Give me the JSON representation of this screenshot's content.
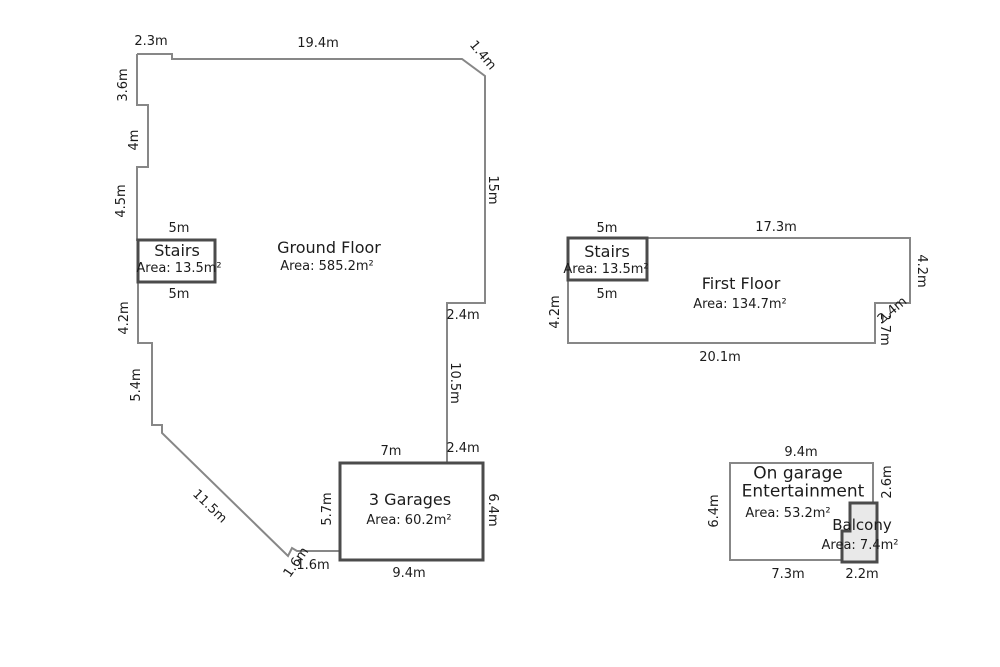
{
  "ground_floor": {
    "title": "Ground Floor",
    "area": "Area: 585.2m²",
    "stairs": {
      "title": "Stairs",
      "area": "Area: 13.5m²",
      "dim_top": "5m",
      "dim_bottom": "5m"
    },
    "dims": {
      "top_left": "2.3m",
      "top": "19.4m",
      "top_right_diag": "1.4m",
      "left_1": "3.6m",
      "left_2": "4m",
      "left_3": "4.5m",
      "left_4": "4.2m",
      "left_5": "5.4m",
      "diagonal": "11.5m",
      "notch": "1.6m",
      "right_1": "15m",
      "right_step": "2.4m",
      "right_2": "10.5m",
      "right_bottom_step": "2.4m"
    }
  },
  "garage": {
    "title": "3 Garages",
    "area": "Area: 60.2m²",
    "dims": {
      "top": "7m",
      "left": "5.7m",
      "right": "6.4m",
      "bottom": "9.4m"
    }
  },
  "first_floor": {
    "title": "First Floor",
    "area": "Area: 134.7m²",
    "stairs": {
      "title": "Stairs",
      "area": "Area: 13.5m²",
      "dim_top": "5m",
      "dim_bottom": "5m"
    },
    "dims": {
      "top": "17.3m",
      "left": "4.2m",
      "right": "4.2m",
      "notch_h": "2.4m",
      "notch_v": "2.7m",
      "bottom": "20.1m"
    }
  },
  "entertainment": {
    "title_line1": "On garage",
    "title_line2": "Entertainment",
    "area": "Area: 53.2m²",
    "balcony": {
      "title": "Balcony",
      "area": "Area: 7.4m²"
    },
    "dims": {
      "top": "9.4m",
      "left": "6.4m",
      "right": "2.6m",
      "bottom_left": "7.3m",
      "bottom_right": "2.2m"
    }
  },
  "colors": {
    "outline": "#878787",
    "walls": "#4b4b4b",
    "text": "#1c1c1c"
  }
}
